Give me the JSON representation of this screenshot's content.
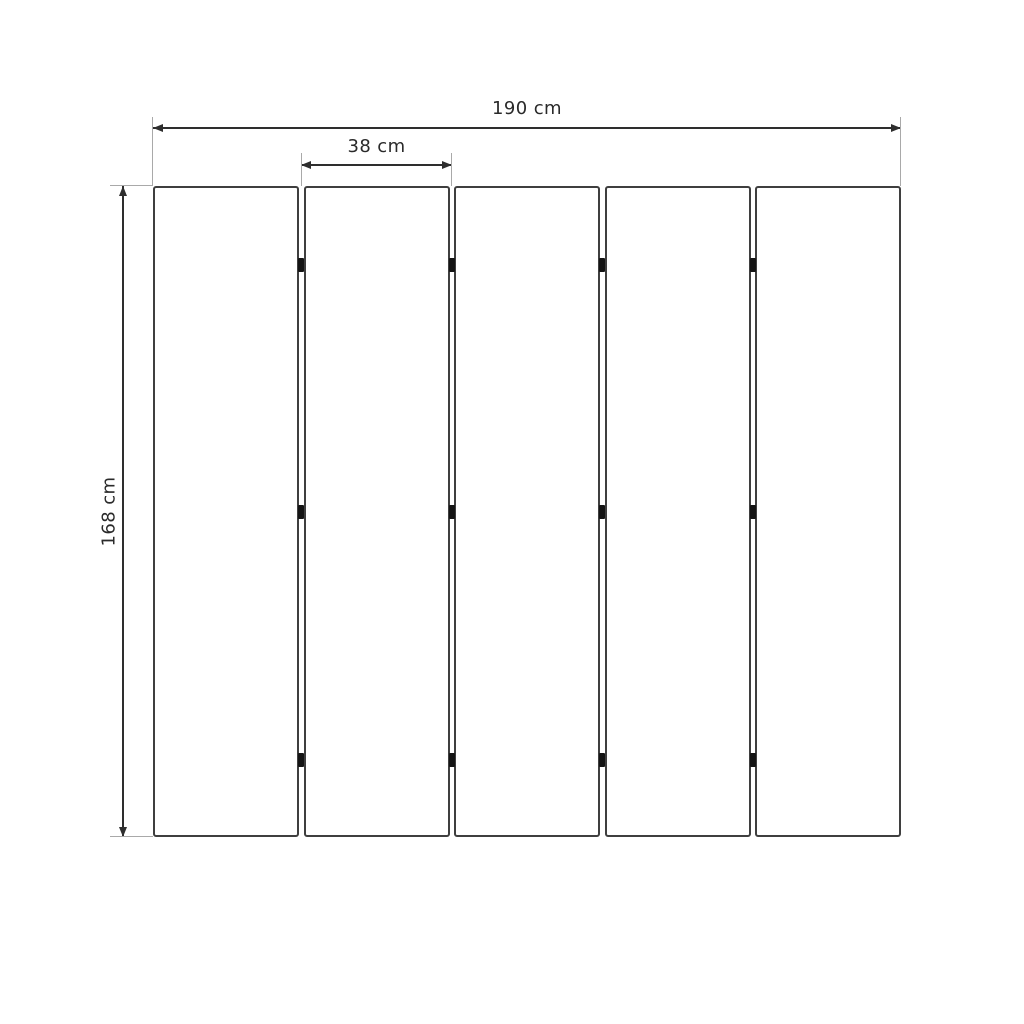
{
  "diagram": {
    "description": "Five vertical panels with connectors - dimensioned technical drawing",
    "panel_count": 5,
    "connector_rows_per_gap": 3,
    "dimensions": {
      "total_width_label": "190 cm",
      "panel_width_label": "38 cm",
      "height_label": "168 cm"
    },
    "colors": {
      "background": "#ffffff",
      "panel_fill": "#ffffff",
      "panel_border": "#3f3f3f",
      "dimension_line": "#2e2e2e",
      "extension_line": "#a9a9a9",
      "connector": "#141414",
      "label_text": "#2a2a2a"
    }
  }
}
